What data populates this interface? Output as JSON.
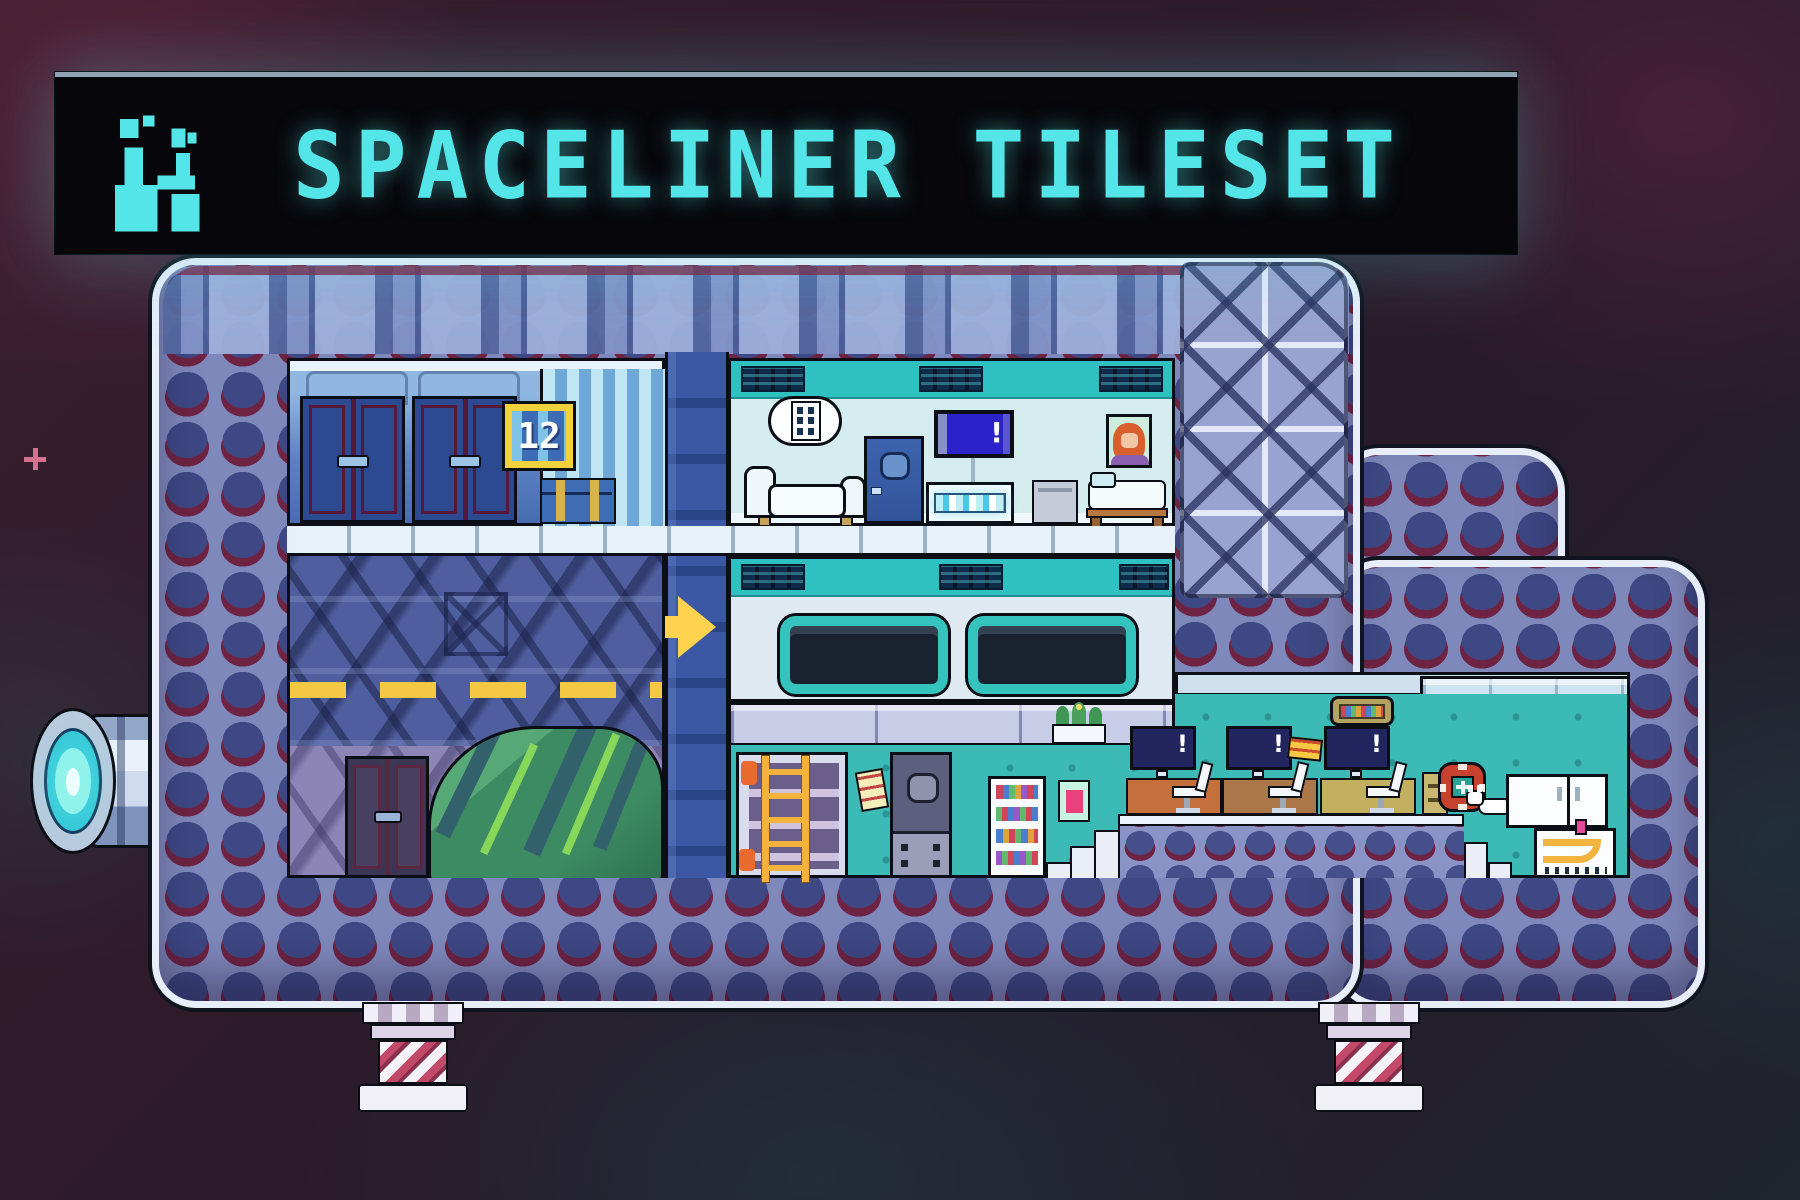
{
  "banner": {
    "title": "SPACELINER TILESET",
    "accent_color": "#54e5e9",
    "background_color": "#07070b",
    "icon": "pixel-factory-rocket-icon"
  },
  "scene": {
    "description": "pixel-art spaceship cross-section tileset showcase",
    "background_color": "#2d1b28",
    "ship": {
      "hull": {
        "plating_color": "#3d4884",
        "rivet_color": "#6e2342",
        "frame_color": "#8a93c6",
        "edge_color": "#e7edf9"
      },
      "storage_room": {
        "door_sign": "12",
        "items": [
          "locker-doors",
          "locker-doors",
          "slat-panel",
          "cargo-trunk"
        ]
      },
      "living_quarters": {
        "tv_alert": "!",
        "items": [
          "ceiling-vent",
          "wall-control-lamp",
          "couch",
          "porthole-door",
          "tv-screen",
          "drink-shelf",
          "nightstand",
          "portrait",
          "bed"
        ]
      },
      "corridor": {
        "direction_arrow_color": "#ffd34e",
        "items": [
          "ceiling-vent",
          "window",
          "window"
        ]
      },
      "cargo_bay": {
        "items": [
          "x-brace-wall",
          "hazard-stripe",
          "double-door",
          "tarp-covered-cargo"
        ]
      },
      "workshop": {
        "items": [
          "storage-rack",
          "ladder",
          "sticky-note",
          "porthole-door",
          "bookshelf",
          "poster",
          "planter"
        ]
      },
      "computer_deck": {
        "monitor_alert": "!",
        "items": [
          "workstation",
          "workstation",
          "workstation",
          "wall-bookshelf",
          "ticket",
          "stairs",
          "raised-platform",
          "file-cabinet"
        ]
      },
      "utility_corner": {
        "items": [
          "life-ring",
          "cat",
          "fridge",
          "washer-with-pipes"
        ]
      },
      "exterior": {
        "items": [
          "engine-thruster",
          "landing-leg",
          "landing-leg",
          "x-brace-armor-tiles"
        ]
      }
    }
  }
}
